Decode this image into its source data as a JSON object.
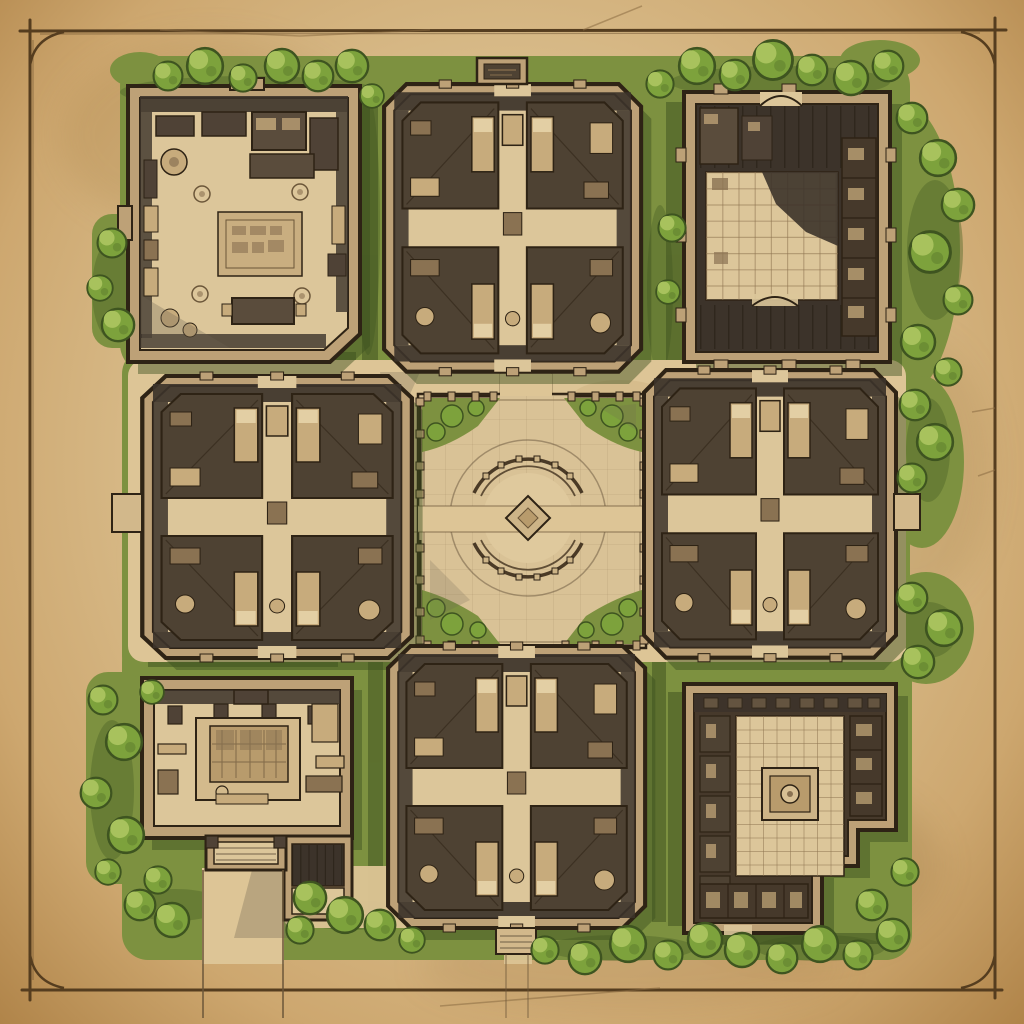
{
  "map": {
    "kind": "hand-drawn top-down fantasy estate floor plan on aged parchment",
    "frame": "thin hand-inked rectangular border with quarter-arc corner flourishes",
    "plaza": {
      "label": "central-circular-plaza",
      "rings": 2,
      "balustrade_posts": true,
      "center_marker": "diamond inlay",
      "corner_gardens": 4,
      "path_gaps": "east and west openings for the crossing path"
    },
    "buildings": [
      {
        "id": "nw",
        "label": "northwest-great-hall",
        "kind": "open hall with patterned rug, tables, shelves and barrels"
      },
      {
        "id": "n",
        "label": "north-dormitory",
        "kind": "four-room dormitory around a cross corridor, north sign porch"
      },
      {
        "id": "ne",
        "label": "northeast-warehouse",
        "kind": "dark-roofed storehouse around a tiled inner court with arched doors"
      },
      {
        "id": "w",
        "label": "west-dormitory",
        "kind": "four-room dormitory around a cross corridor, west balcony"
      },
      {
        "id": "e",
        "label": "east-dormitory",
        "kind": "four-room dormitory around a cross corridor, east balcony"
      },
      {
        "id": "sw",
        "label": "southwest-shrine-hall",
        "kind": "hall with central dais and altar, south porch, steps and exit path"
      },
      {
        "id": "s",
        "label": "south-dormitory",
        "kind": "four-room dormitory around a cross corridor, south porch"
      },
      {
        "id": "se",
        "label": "southeast-temple-hall",
        "kind": "tiled ceremonial hall with central platform, cell rooms and stepped corner"
      }
    ],
    "paths": [
      "east-west axis through plaza",
      "north-south axis through plaza",
      "southwest exit path crossing the frame",
      "south exit path crossing the frame"
    ],
    "vegetation": "round-canopy tree clusters and lawns surrounding the compound"
  },
  "palette": {
    "parchment": "#d9bd8c",
    "parchment_light": "#e8d6ac",
    "parchment_dark": "#b08449",
    "frame_line": "#553d1f",
    "crack": "#8a6b42",
    "grass": "#7d9140",
    "grass_dark": "#4f6628",
    "grass_shadow": "#3c4f1e",
    "tree_mid": "#7da23c",
    "tree_light": "#a8c25d",
    "tree_dark": "#3e5420",
    "court": "#ddc596",
    "path_edge": "#6b5639",
    "ink": "#2e2315",
    "wall": "#bda177",
    "wall_light": "#d2b88b",
    "roof_dark": "#3c332a",
    "room_dark": "#4e4233",
    "floor": "#dcc69a",
    "furniture": "#c7ab7c",
    "furniture_light": "#e3cfa4",
    "furniture_dark": "#8a7252",
    "stone": "#d9c296",
    "stone_light": "#dfc99d",
    "stone_dark": "#cdb487",
    "wood_dark": "#4f4236",
    "wood_mid": "#5a4c3c",
    "cell_dark": "#46392b",
    "dais": "#d3ba8c",
    "altar": "#b89b6c",
    "rug": "#c9ae80",
    "glyph": "#8a7252",
    "ring": "#4a3a26",
    "grid_line": "#8d7350",
    "beam": "#241c12",
    "shadow_int": "#6e6352"
  }
}
